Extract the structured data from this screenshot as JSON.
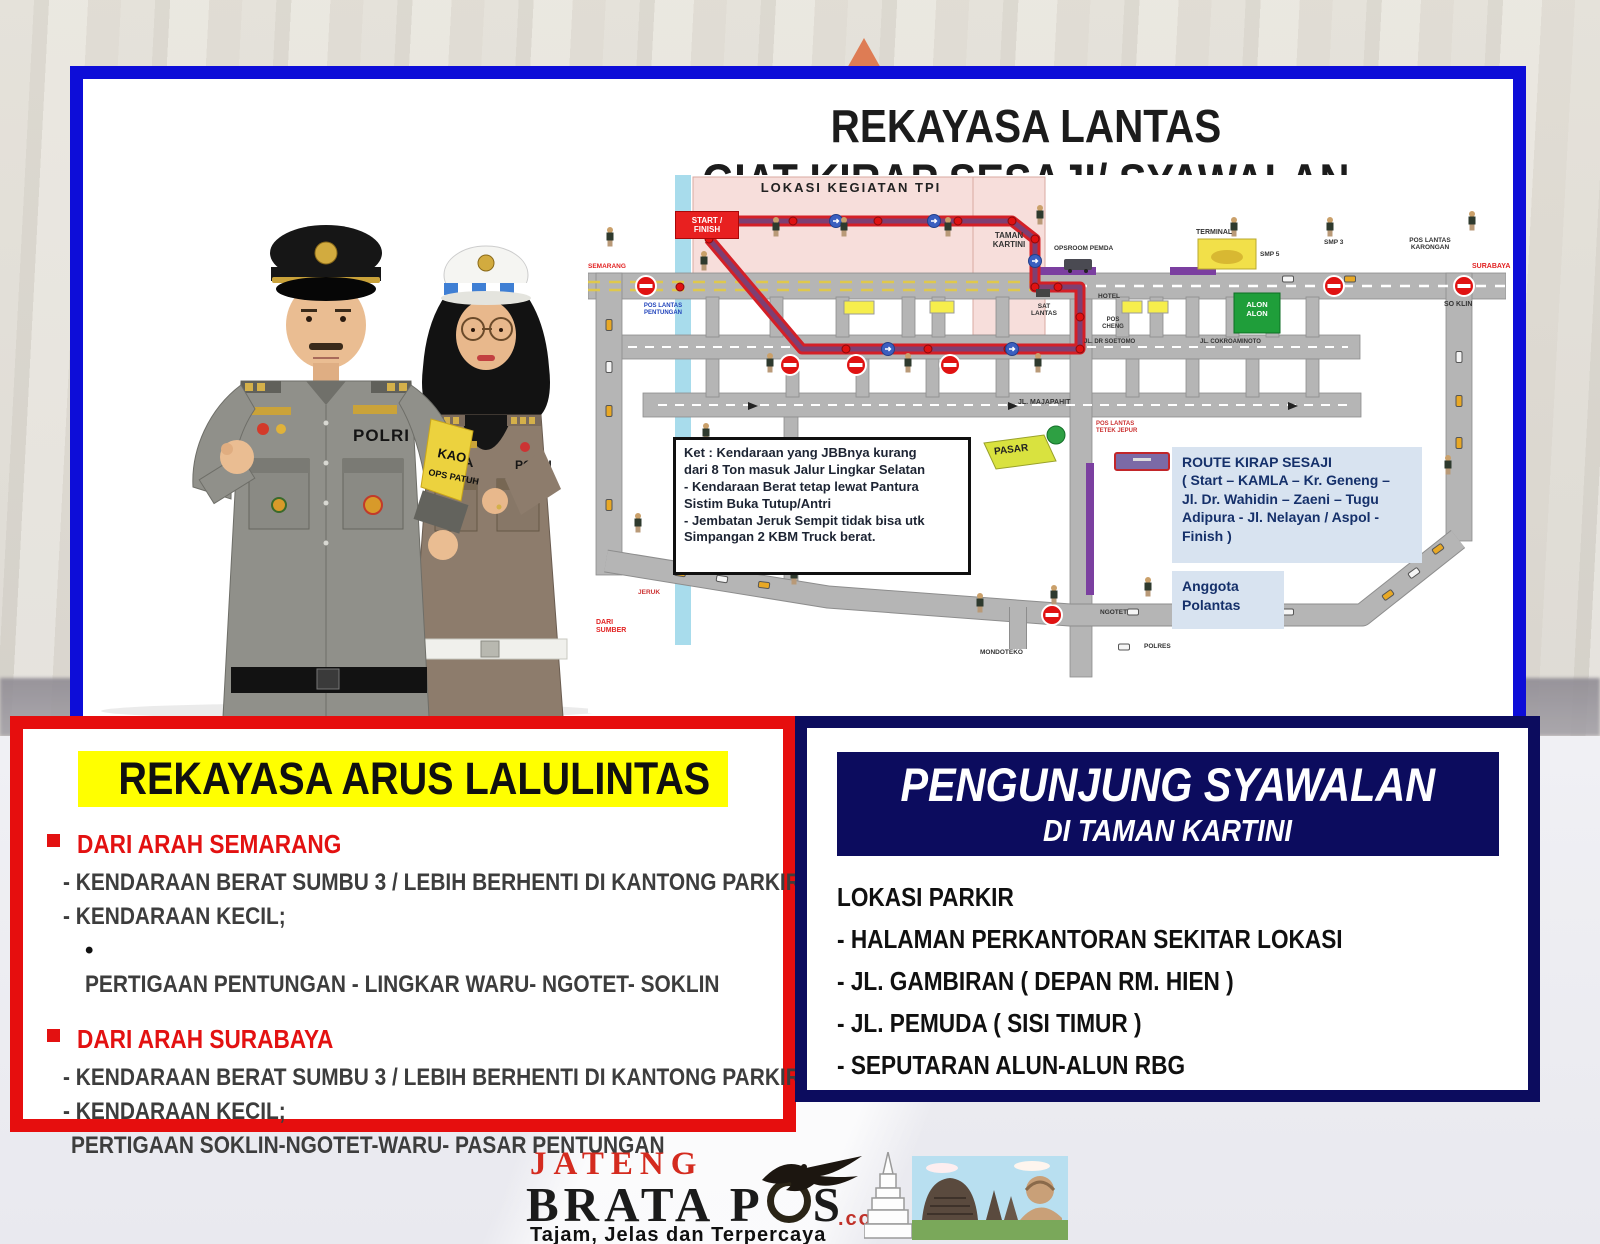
{
  "top_panel": {
    "title_line1": "REKAYASA LANTAS",
    "title_line2": "GIAT KIRAP SESAJI/ SYAWALAN",
    "officers": {
      "male_tag": "POLRI",
      "female_name": "MITHA",
      "female_tag": "POLRI",
      "armband_line1": "KAO",
      "armband_line2": "OPS PATUH"
    },
    "map": {
      "tpi_label": "LOKASI KEGIATAN TPI",
      "start_finish": "START /\nFINISH",
      "taman_kartini": "TAMAN\nKARTINI",
      "opsroom": "OPSROOM PEMDA",
      "smp5": "SMP 5",
      "terminal": "TERMINAL",
      "smp3": "SMP 3",
      "pos_karongan": "POS LANTAS\nKARONGAN",
      "surabaya": "SURABAYA",
      "so_klin": "SO KLIN",
      "alon_alon": "ALON\nALON",
      "hotel": "HOTEL",
      "pos_cheng": "POS\nCHENG",
      "sat_lantas": "SAT\nLANTAS",
      "jl_dr_soetomo": "JL. DR SOETOMO",
      "jl_cokroaminoto": "JL. COKROAMINOTO",
      "jl_majapahit": "JL. MAJAPAHIT",
      "pos_tetek_jepur": "POS LANTAS\nTETEK JEPUR",
      "pos_pentungan": "POS LANTAS\nPENTUNGAN",
      "semarang": "SEMARANG",
      "dari_sumber": "DARI\nSUMBER",
      "jeruk": "JERUK",
      "mondoteko": "MONDOTEKO",
      "ngotet": "NGOTET",
      "polres": "POLRES",
      "pasar": "PASAR",
      "ket_text": "Ket : Kendaraan yang JBBnya kurang\ndari 8 Ton masuk Jalur Lingkar Selatan\n- Kendaraan Berat tetap lewat Pantura\nSistim Buka Tutup/Antri\n- Jembatan Jeruk Sempit tidak bisa utk\nSimpangan 2 KBM Truck berat.",
      "route_box": "ROUTE KIRAP SESAJI\n( Start – KAMLA – Kr. Geneng –\nJl. Dr. Wahidin – Zaeni  –  Tugu\nAdipura  - Jl. Nelayan / Aspol -\nFinish )",
      "legend_officer": "Anggota\nPolantas"
    }
  },
  "left_panel": {
    "title": "REKAYASA ARUS LALULINTAS",
    "section1": {
      "heading": "DARI ARAH SEMARANG",
      "line1": "- KENDARAAN BERAT SUMBU 3 / LEBIH BERHENTI DI KANTONG PARKIR",
      "line2": "- KENDARAAN KECIL;",
      "line3": "PERTIGAAN PENTUNGAN - LINGKAR WARU- NGOTET- SOKLIN"
    },
    "section2": {
      "heading": "DARI ARAH SURABAYA",
      "line1": "- KENDARAAN BERAT SUMBU 3 / LEBIH BERHENTI DI KANTONG PARKIR",
      "line2": "- KENDARAAN KECIL;",
      "line3": "PERTIGAAN SOKLIN-NGOTET-WARU- PASAR PENTUNGAN"
    }
  },
  "right_panel": {
    "header_line1": "PENGUNJUNG SYAWALAN",
    "header_line2": "DI TAMAN KARTINI",
    "list_title": "LOKASI PARKIR",
    "item1": "- HALAMAN PERKANTORAN SEKITAR LOKASI",
    "item2": "- JL. GAMBIRAN ( DEPAN RM. HIEN )",
    "item3": "- JL. PEMUDA ( SISI TIMUR )",
    "item4": "- SEPUTARAN ALUN-ALUN RBG"
  },
  "footer": {
    "brand_top": "JATENG",
    "brand_main": "BRATA P",
    "brand_s": "S",
    "brand_com": ".com",
    "tagline": "Tajam, Jelas dan Terpercaya"
  },
  "colors": {
    "panel_blue": "#0d0dd8",
    "panel_red": "#e60e0e",
    "panel_navy": "#0c0c5e",
    "highlight_yellow": "#ffff00",
    "route_red": "#d42027"
  }
}
